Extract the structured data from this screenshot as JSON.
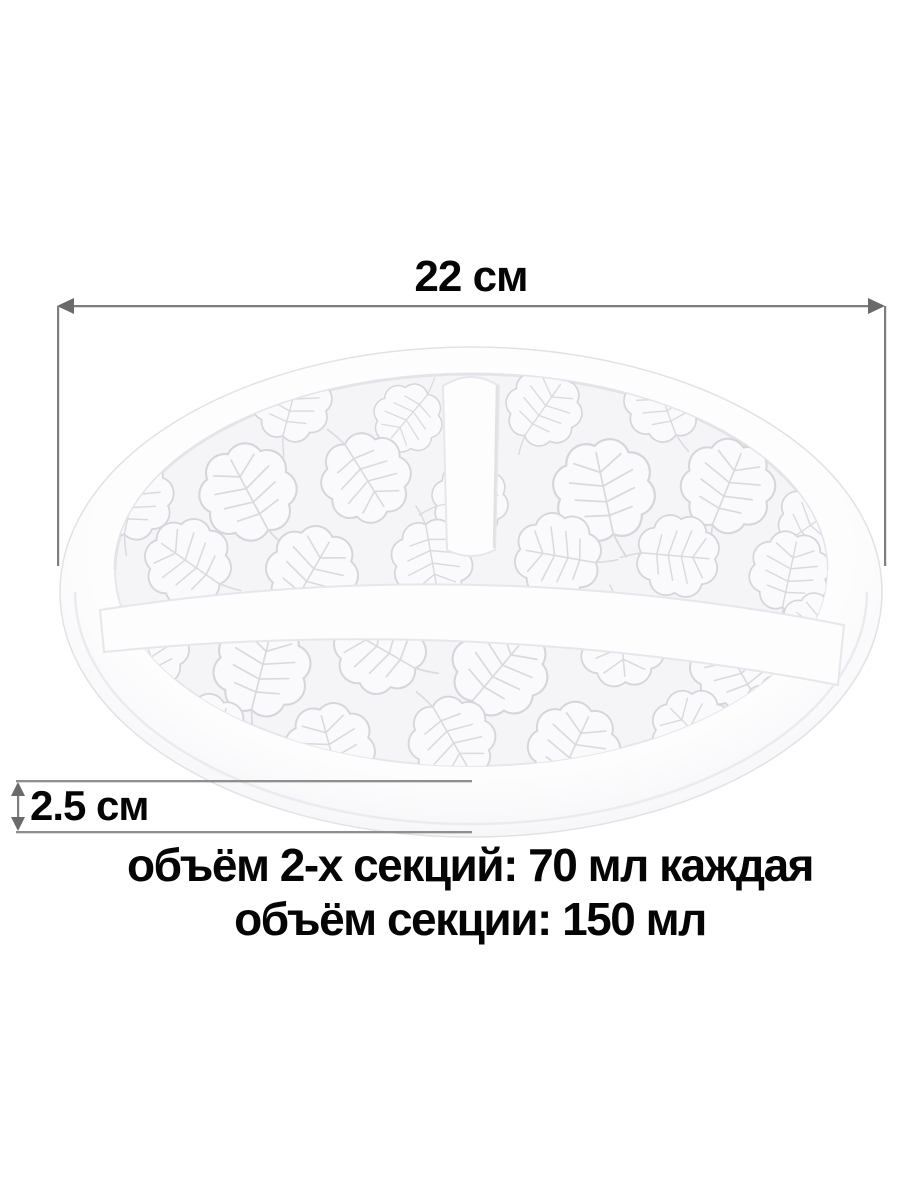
{
  "product_image": {
    "dimensions": {
      "diameter_label": "22 см",
      "height_label": "2.5 см"
    },
    "volume_info": {
      "line1": "объём 2-х секций: 70 мл каждая",
      "line2": "объём секции: 150 мл"
    },
    "object": {
      "description_name": "divided-plate-with-monstera-leaf-embossing",
      "section_count_visible": 3
    }
  },
  "style": {
    "background": "#ffffff",
    "text_color": "#050505",
    "dimension_line_color": "#7d7d7d",
    "arrowhead_color": "#6a6a6a",
    "plate_base_color": "#ffffff",
    "plate_shading_color": "#ececf0",
    "plate_floor_color": "#f5f5f8",
    "emboss_line_color": "#d5d6db"
  }
}
